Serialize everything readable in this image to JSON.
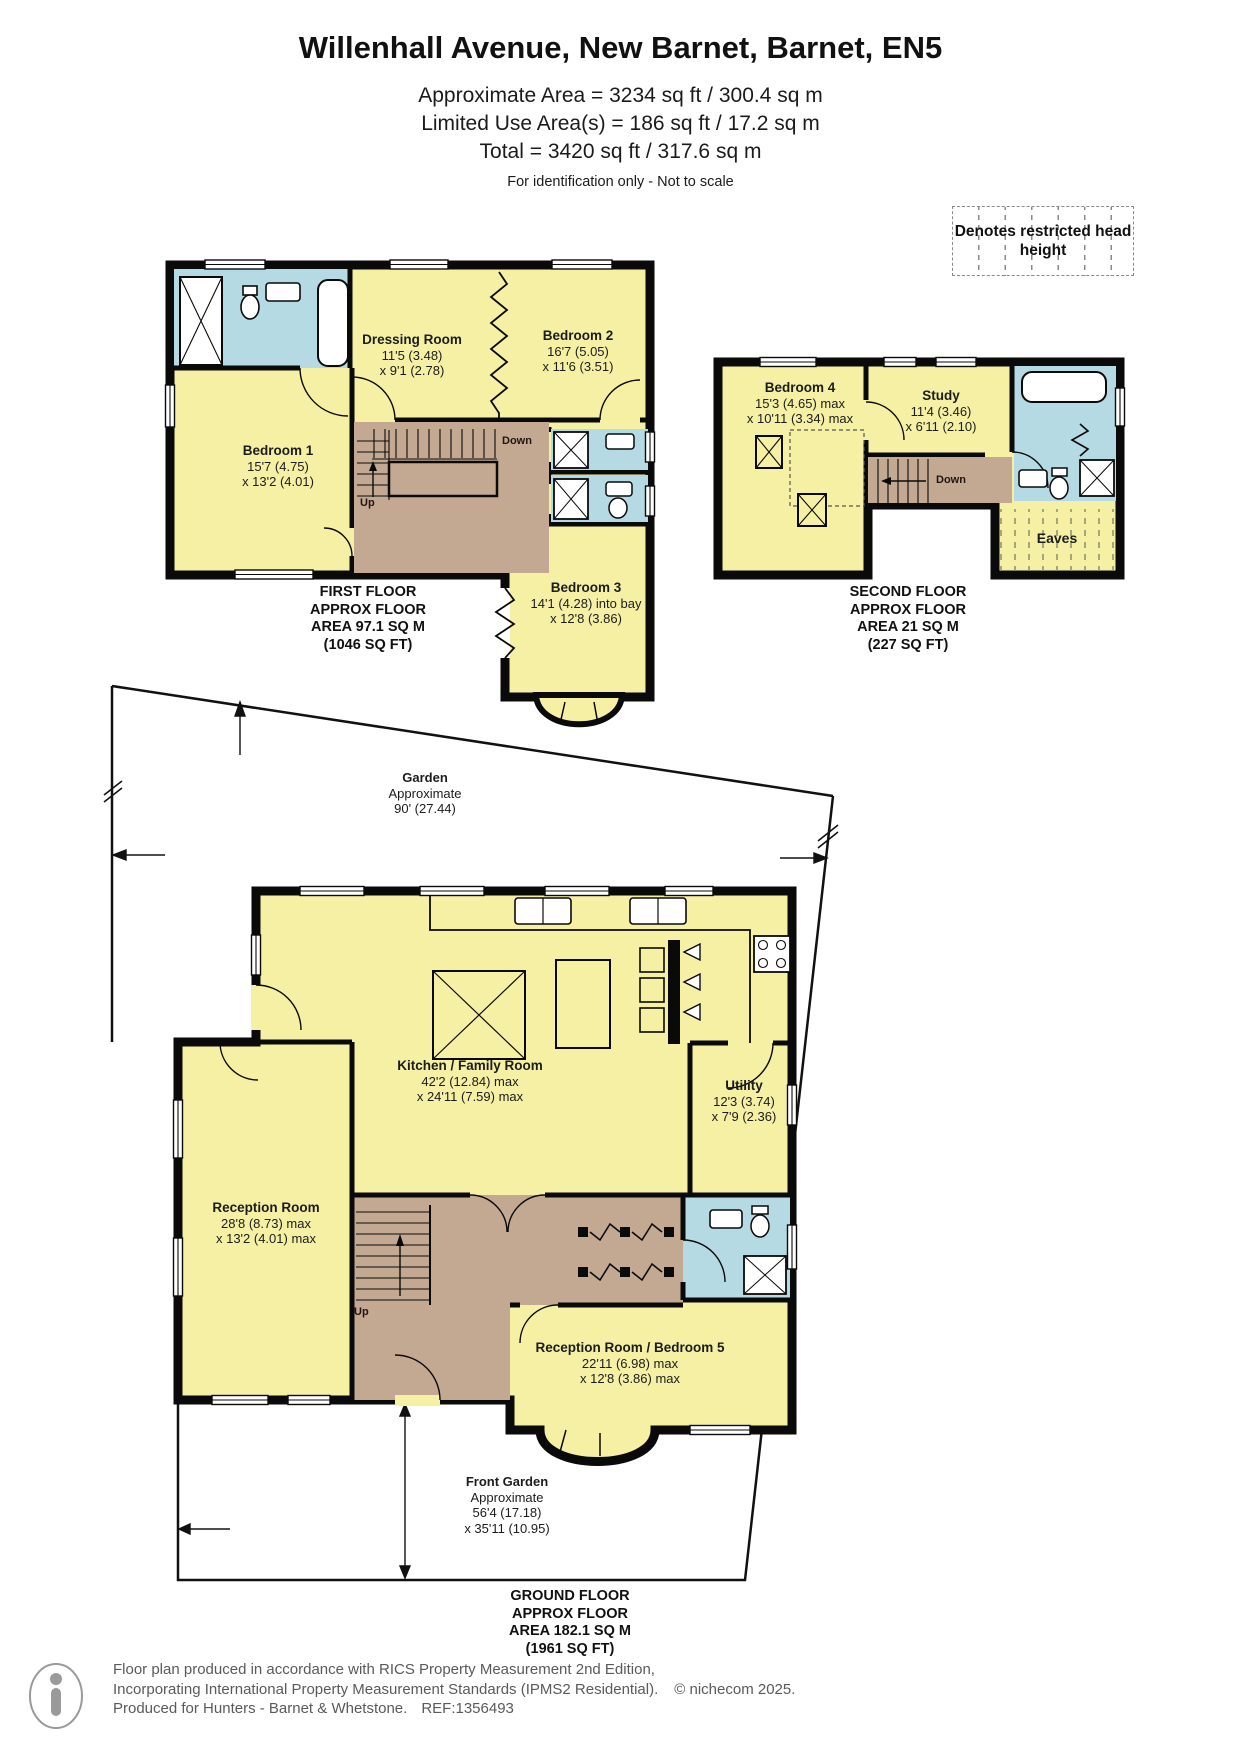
{
  "header": {
    "title": "Willenhall Avenue, New Barnet, Barnet, EN5",
    "area_line_1": "Approximate Area = 3234 sq ft / 300.4 sq m",
    "area_line_2": "Limited Use Area(s) = 186 sq ft / 17.2 sq m",
    "area_line_3": "Total = 3420 sq ft / 317.6 sq m",
    "disclaimer": "For identification only - Not to scale"
  },
  "legend": {
    "restricted_head_height": "Denotes restricted head height"
  },
  "first_floor": {
    "caption": [
      "FIRST FLOOR",
      "APPROX FLOOR",
      "AREA 97.1 SQ M",
      "(1046 SQ FT)"
    ],
    "rooms": {
      "bedroom1": {
        "name": "Bedroom 1",
        "dims": [
          "15'7 (4.75)",
          "x 13'2 (4.01)"
        ]
      },
      "dressing_room": {
        "name": "Dressing Room",
        "dims": [
          "11'5 (3.48)",
          "x 9'1 (2.78)"
        ]
      },
      "bedroom2": {
        "name": "Bedroom 2",
        "dims": [
          "16'7 (5.05)",
          "x 11'6 (3.51)"
        ]
      },
      "bedroom3": {
        "name": "Bedroom 3",
        "dims": [
          "14'1 (4.28) into bay",
          "x 12'8 (3.86)"
        ]
      }
    },
    "stairs": {
      "down": "Down",
      "up": "Up"
    }
  },
  "second_floor": {
    "caption": [
      "SECOND FLOOR",
      "APPROX FLOOR",
      "AREA 21 SQ M",
      "(227 SQ FT)"
    ],
    "rooms": {
      "bedroom4": {
        "name": "Bedroom 4",
        "dims": [
          "15'3 (4.65) max",
          "x 10'11 (3.34) max"
        ]
      },
      "study": {
        "name": "Study",
        "dims": [
          "11'4 (3.46)",
          "x 6'11 (2.10)"
        ]
      },
      "eaves": {
        "name": "Eaves"
      }
    },
    "stairs": {
      "down": "Down"
    }
  },
  "ground_floor": {
    "caption": [
      "GROUND FLOOR",
      "APPROX FLOOR",
      "AREA 182.1 SQ M",
      "(1961 SQ FT)"
    ],
    "rooms": {
      "kitchen_family": {
        "name": "Kitchen / Family Room",
        "dims": [
          "42'2 (12.84) max",
          "x 24'11 (7.59) max"
        ]
      },
      "utility": {
        "name": "Utility",
        "dims": [
          "12'3 (3.74)",
          "x 7'9 (2.36)"
        ]
      },
      "reception": {
        "name": "Reception Room",
        "dims": [
          "28'8 (8.73) max",
          "x 13'2 (4.01) max"
        ]
      },
      "reception_bedroom5": {
        "name": "Reception Room / Bedroom 5",
        "dims": [
          "22'11 (6.98) max",
          "x 12'8 (3.86) max"
        ]
      }
    },
    "stairs": {
      "up": "Up"
    },
    "garden": {
      "name": "Garden",
      "lines": [
        "Approximate",
        "90' (27.44)"
      ]
    },
    "front_garden": {
      "name": "Front Garden",
      "lines": [
        "Approximate",
        "56'4 (17.18)",
        "x 35'11 (10.95)"
      ]
    }
  },
  "footer": {
    "line1": "Floor plan produced in accordance with RICS Property Measurement 2nd Edition,",
    "line2": "Incorporating International Property Measurement Standards (IPMS2 Residential).",
    "copyright": "© nichecom 2025.",
    "line3": "Produced for Hunters - Barnet & Whetstone.",
    "ref": "REF:1356493"
  },
  "colors": {
    "room_fill": "#F5F0A3",
    "wet_fill": "#B5DAE4",
    "hall_fill": "#C3A992",
    "wall": "#0A0A0A"
  }
}
